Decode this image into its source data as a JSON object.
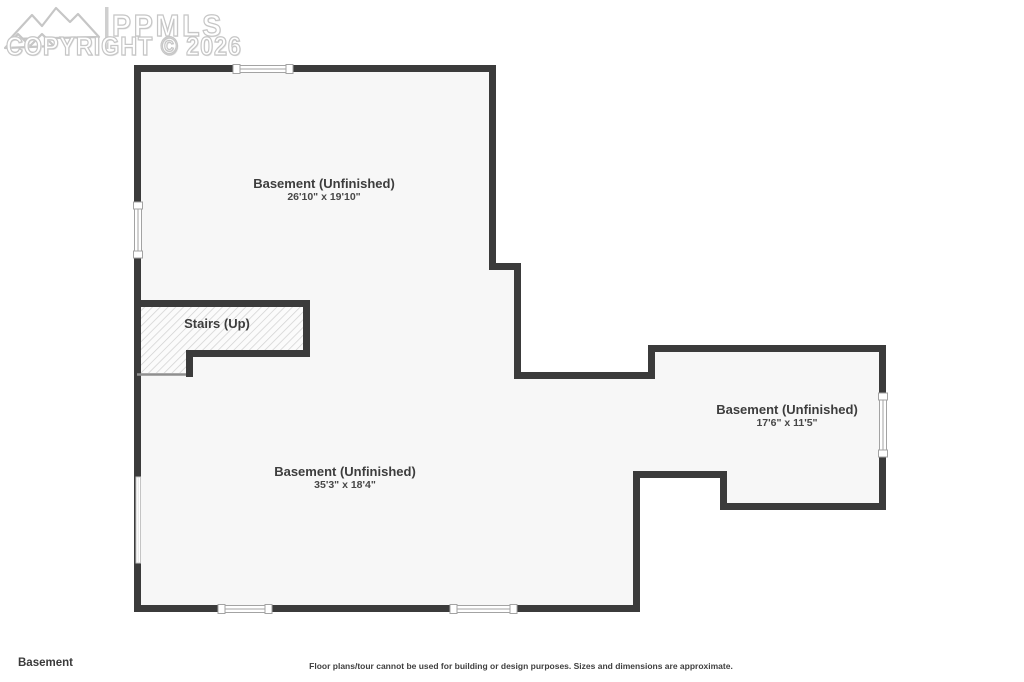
{
  "watermark": {
    "logo_icon": "mountain-range-icon",
    "brand": "PPMLS",
    "copyright_line": "COPYRIGHT © 2026"
  },
  "plan": {
    "rooms": [
      {
        "name": "Basement (Unfinished)",
        "dims": "26'10\" x 19'10\""
      },
      {
        "name": "Basement (Unfinished)",
        "dims": "35'3\" x 18'4\""
      },
      {
        "name": "Basement (Unfinished)",
        "dims": "17'6\" x 11'5\""
      }
    ],
    "stairs_label": "Stairs (Up)"
  },
  "footer": {
    "floor_label": "Basement",
    "disclaimer": "Floor plans/tour cannot be used for building or design purposes. Sizes and dimensions are approximate."
  },
  "colors": {
    "background": "#ffffff",
    "wall": "#3b3b3b",
    "room_fill": "#f7f7f7",
    "hatch_line": "#d0d0d0",
    "stair_edge": "#8f8f8f",
    "window_stroke": "#a3a3a3",
    "label_text": "#3d3d3d",
    "watermark": "#c6c6c6"
  }
}
